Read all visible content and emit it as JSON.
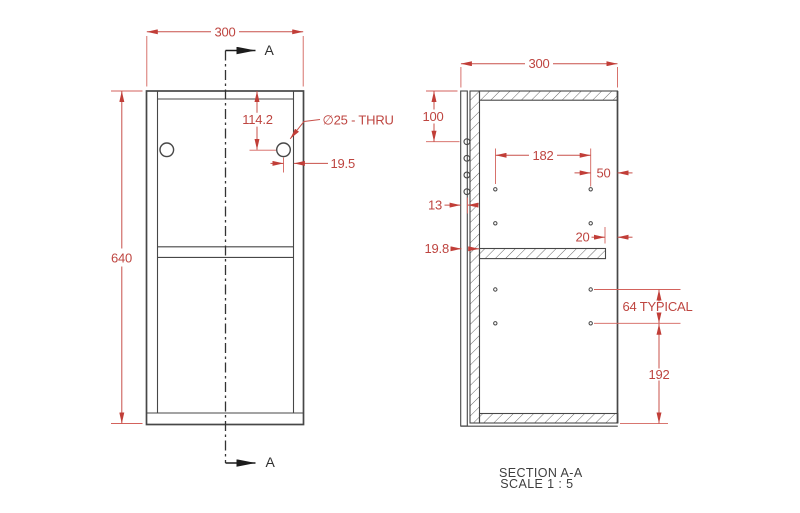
{
  "front_view": {
    "width_dim": "300",
    "height_dim": "640",
    "hole_offset_dim": "114.2",
    "hole_callout": "∅25 - THRU",
    "hole_edge_dim": "19.5",
    "section_arrow_top_label": "A",
    "section_arrow_bottom_label": "A"
  },
  "section_view": {
    "width_dim": "300",
    "top_panel_dim": "100",
    "pin_span_dim": "182",
    "pin_right_dim": "50",
    "back_panel_dim": "13",
    "shelf_thickness_dim": "19.8",
    "shelf_gap_dim": "20",
    "pin_pitch_dim": "64 TYPICAL",
    "bottom_dim": "192",
    "title": "SECTION A-A",
    "scale": "SCALE 1 : 5"
  },
  "colors": {
    "dimension_red": "#C8473F",
    "geometry_gray": "#474747",
    "background": "#FFFFFF"
  }
}
